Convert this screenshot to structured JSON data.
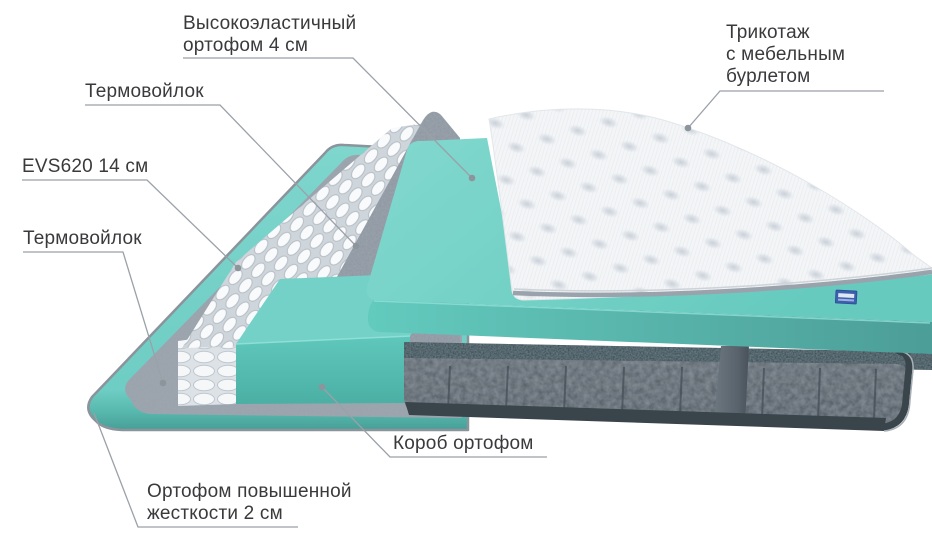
{
  "diagram": {
    "type": "mattress-layers-diagram",
    "labels": [
      {
        "id": "top-foam",
        "lines": [
          "Высокоэластичный",
          "ортофом 4 см"
        ]
      },
      {
        "id": "felt-upper",
        "lines": [
          "Термовойлок"
        ]
      },
      {
        "id": "spring-unit",
        "lines": [
          "EVS620 14 см"
        ]
      },
      {
        "id": "felt-lower",
        "lines": [
          "Термовойлок"
        ]
      },
      {
        "id": "knit-cover",
        "lines": [
          "Трикотаж",
          "с мебельным",
          "бурлетом"
        ]
      },
      {
        "id": "foam-box",
        "lines": [
          "Короб ортофом"
        ]
      },
      {
        "id": "base-foam",
        "lines": [
          "Ортофом повышенной",
          "жесткости 2 см"
        ]
      }
    ],
    "colors": {
      "foam_teal": "#6fcfc5",
      "foam_teal_dark": "#4aa79e",
      "felt_gray": "#8d96a0",
      "body_gray": "#525b63",
      "body_rail": "#2d3b42",
      "quilt_white": "#f3f5f7",
      "spring_white": "#f8fafb",
      "leader_line": "#9aa1a8",
      "text": "#3a3a3d",
      "brand_tag_blue": "#3c5fae",
      "background": "#ffffff"
    }
  }
}
